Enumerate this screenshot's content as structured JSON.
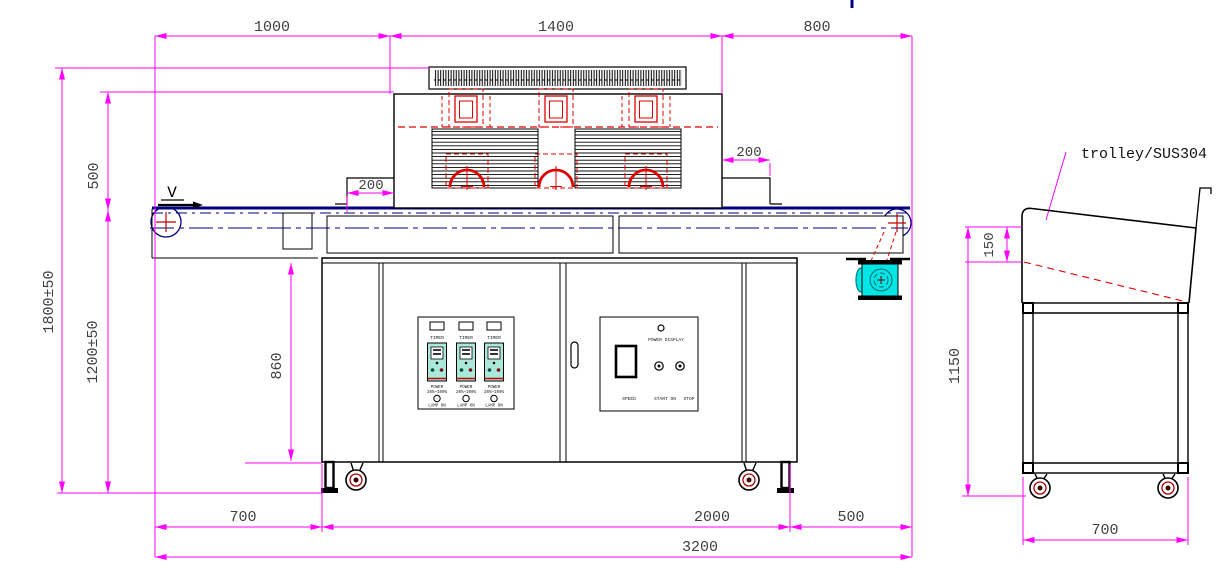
{
  "labels": {
    "direction": "V",
    "trolley": "trolley/SUS304"
  },
  "dims": {
    "top": [
      "1000",
      "1400",
      "800"
    ],
    "left": [
      "1800±50",
      "500",
      "1200±50"
    ],
    "lamp_offset_left": "200",
    "lamp_offset_right": "200",
    "cabinet_height": "860",
    "bottom": [
      "700",
      "2000",
      "500"
    ],
    "total": "3200",
    "trolley": {
      "lip": "150",
      "height": "1150",
      "width": "700"
    }
  },
  "lamp_panel": {
    "timer": "TIMER",
    "power": "POWER",
    "range": "20%~100%",
    "lamp_on": "LAMP ON"
  },
  "main_panel": {
    "power_display": "POWER DISPLAY",
    "speed": "SPEED",
    "start_on": "START ON",
    "stop": "STOP"
  },
  "colors": {
    "dimension": "#ff00ff",
    "outline": "#000000",
    "conveyor": "#000080",
    "lamp": "#e00000",
    "motor": "#00e6e6",
    "controller": "#aae8dc"
  }
}
